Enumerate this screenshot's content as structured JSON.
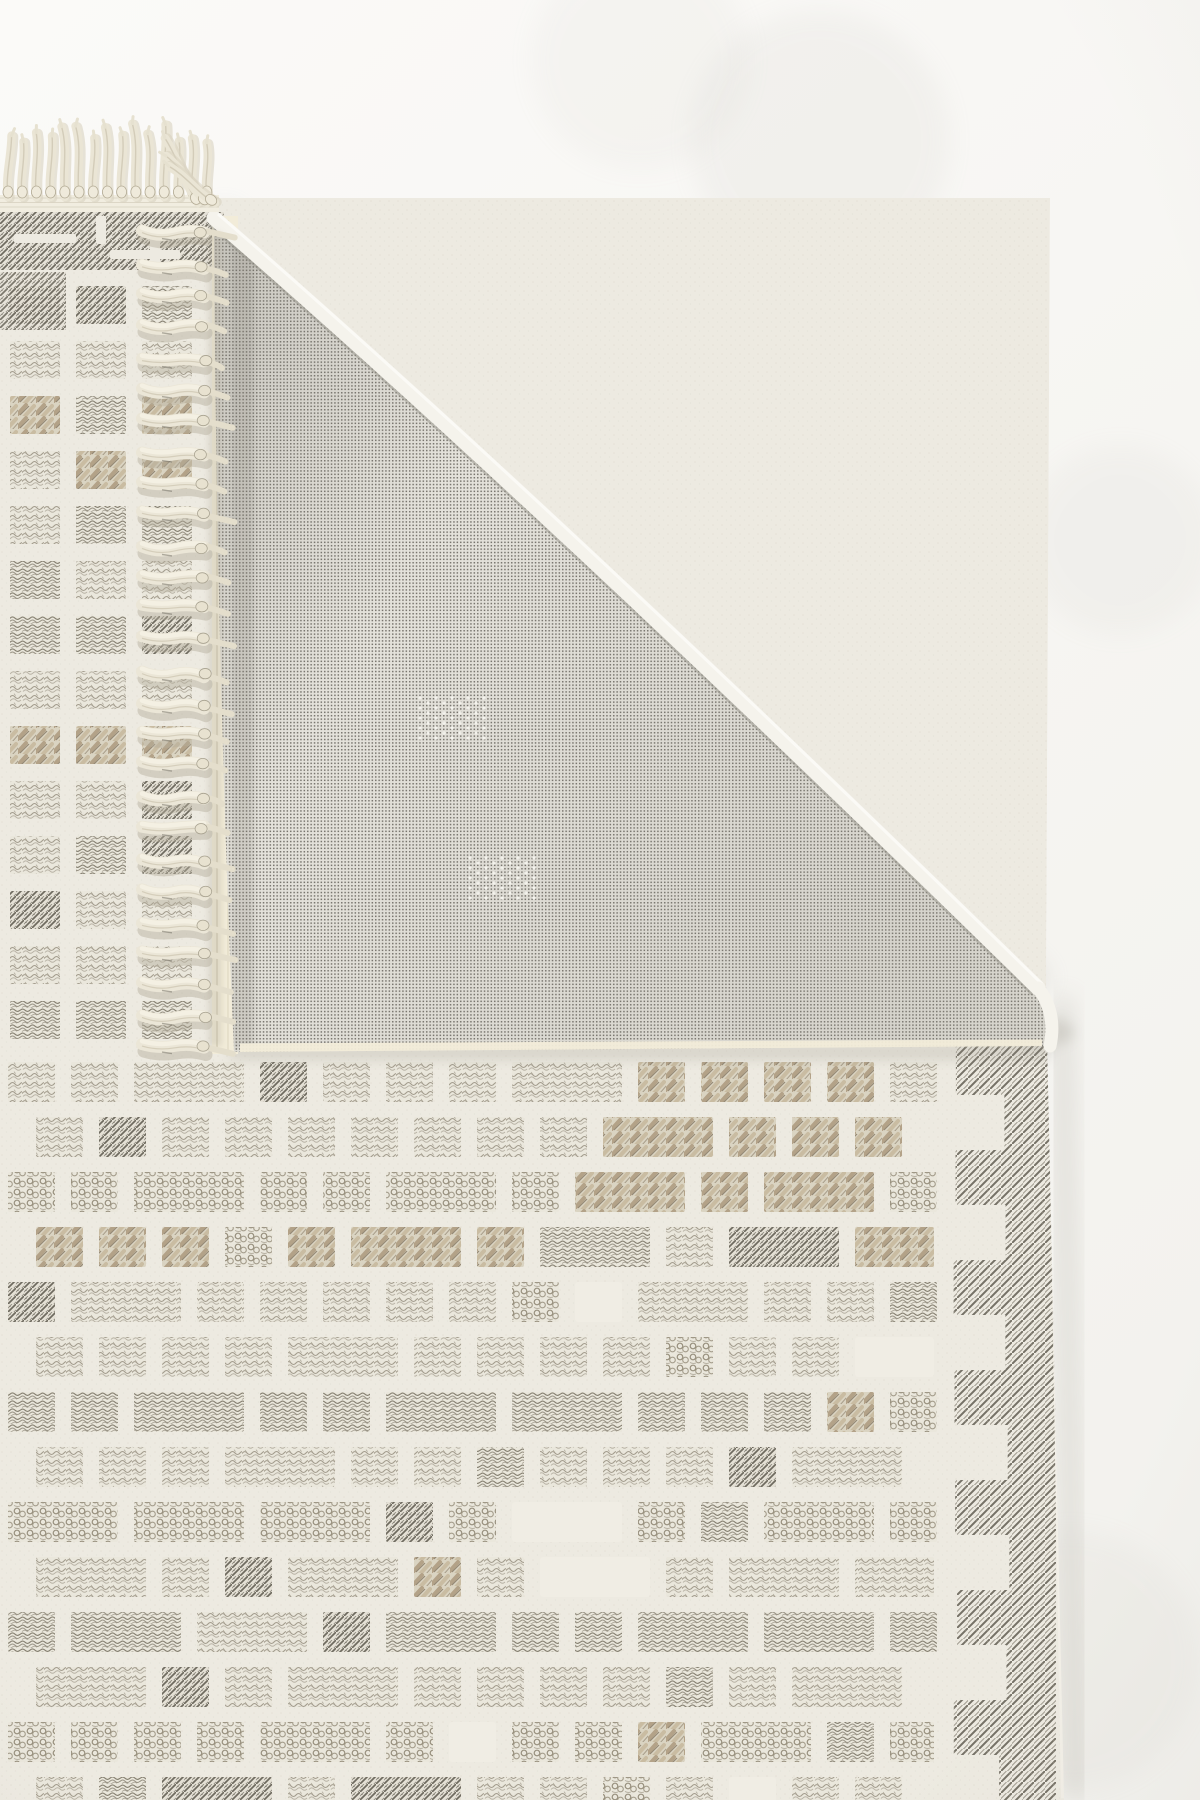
{
  "meta": {
    "description": "Product photograph of a cream geometric waffle-grid rug with knotted fringe; one corner is folded over revealing the grey woven mesh backing."
  },
  "canvas": {
    "w": 1200,
    "h": 1800
  },
  "palette": {
    "bgTop": "#fbfaf8",
    "bgBottom": "#f3f2ee",
    "rugBase": "#edeae1",
    "cellBg": "#e7e4d9",
    "blankCell": "#f0ede4",
    "stitchLight": "#a39c8d",
    "stitchDark": "#857f70",
    "chain": "#968e7c",
    "tan": "#b3a288",
    "tanLight": "#c9bca2",
    "tanDark": "#837663",
    "hatch": "#6e6a5f",
    "borderLine": "#6f6b60",
    "borderLine2": "#8a8578",
    "meshBase": "#e9e7e0",
    "meshDot": "#76736c",
    "bindingCream": "#f2ecd9",
    "bindingEdge": "#d8d1ba",
    "foldEdge": "#f5f3ec",
    "foldInner": "#96938a",
    "edgeBinding": "#f2efe7",
    "fringe": "#ebe6d7",
    "fringeHi": "#f4f0e3",
    "fringeLine": "#cfc8b4",
    "fringeKnot": "#e8e2d0",
    "fringeKnotEdge": "#a9a391",
    "fringeShadow": "#b3ad9c",
    "shadow": "#bcb9b0",
    "underShadow": "#8b877c",
    "motifDot": "#f6f5f0"
  },
  "rug": {
    "outline": [
      [
        -6,
        198
      ],
      [
        1050,
        198
      ],
      [
        1046,
        995
      ],
      [
        1064,
        1800
      ],
      [
        -6,
        1800
      ]
    ],
    "topBorder": {
      "x": -6,
      "y": 212,
      "w": 230,
      "h": 58
    },
    "topBorderSlits": [
      [
        14,
        234,
        62,
        9
      ],
      [
        96,
        216,
        10,
        28
      ],
      [
        150,
        230,
        10,
        40
      ],
      [
        110,
        250,
        70,
        9
      ]
    ],
    "greekExtra": [
      0,
      272,
      66,
      58
    ],
    "leftStrip": {
      "cols": [
        10,
        76,
        142
      ],
      "cellW": 50,
      "cellH": 38,
      "rowStart": 286,
      "rowPitch": 55,
      "rowEnd": 1010,
      "rowTextures": [
        "dense",
        "scribble",
        "basket",
        "basket",
        "scribble",
        "scribble",
        "dense",
        "scribble",
        "basket",
        "scribble",
        "dense",
        "scribble",
        "scribble",
        "dense"
      ]
    },
    "main": {
      "xStart": 8,
      "cellW": 47,
      "gap": 16,
      "cellH": 40,
      "xLimit": 940,
      "rowStart": 1062,
      "rowPitch": 55,
      "rowEnd": 1800,
      "rowTextures": [
        "scribble",
        "scribble",
        "chain",
        "basket",
        "scribble",
        "scribble",
        "dense",
        "scribble",
        "chain",
        "scribble",
        "dense",
        "scribble",
        "chain",
        "scribble"
      ],
      "doubleWidthChance": 0.3,
      "blankChance": 0.05,
      "darkChance": 0.07,
      "deviateChance": 0.2,
      "seed": 7
    },
    "basketCluster": {
      "rows": [
        1062,
        1117,
        1172
      ],
      "x1": 555,
      "x2": 860
    },
    "rightBorder": {
      "yStart": 985,
      "deepX": 952,
      "shallowX": 1004,
      "rightX": 1056,
      "step": 55
    },
    "edgeBindingLine": [
      [
        1052,
        998
      ],
      [
        1066,
        1798
      ]
    ]
  },
  "mesh": {
    "apex": [
      214,
      218
    ],
    "hypControl": [
      545,
      505
    ],
    "corner": [
      1038,
      988
    ],
    "cornerControl": [
      1057,
      1012
    ],
    "cornerEnd": [
      1050,
      1046
    ],
    "bottomLeft": [
      234,
      1052
    ],
    "leftControl": [
      216,
      645
    ],
    "bindingBand": {
      "x": 212,
      "y": 216,
      "w": 26,
      "h": 838
    },
    "bottomBinding": [
      [
        240,
        1048
      ],
      [
        1042,
        1044
      ]
    ],
    "motifs": [
      {
        "cx": 452,
        "cy": 718,
        "n": 4,
        "dx": 8,
        "dy": 5
      },
      {
        "cx": 502,
        "cy": 878,
        "n": 4,
        "dx": 8,
        "dy": 5
      }
    ]
  },
  "fringeTop": {
    "count": 15,
    "x0": 8,
    "pitch": 14.2,
    "baseY": 197,
    "lenMin": 52,
    "lenVar": 22,
    "band": {
      "x": 0,
      "y": 195,
      "w": 219,
      "h": 17
    },
    "corner": [
      {
        "x": 198,
        "rot": -28
      },
      {
        "x": 207,
        "rot": -40
      },
      {
        "x": 215,
        "rot": -52
      }
    ]
  },
  "fringeSide": {
    "count": 27,
    "y0": 232,
    "y1": 1046,
    "x0": 142,
    "len": 62,
    "knotX": 200
  },
  "shadows": {
    "diag": {
      "width": 30,
      "opacity": 0.4
    },
    "right": {
      "width": 16,
      "opacity": 0.45
    },
    "underFlap": {
      "opacity": 0.22
    },
    "bgBlobs": [
      [
        820,
        140,
        130,
        0.1
      ],
      [
        1120,
        540,
        95,
        0.08
      ],
      [
        1070,
        1660,
        130,
        0.08
      ],
      [
        640,
        60,
        110,
        0.07
      ]
    ]
  }
}
